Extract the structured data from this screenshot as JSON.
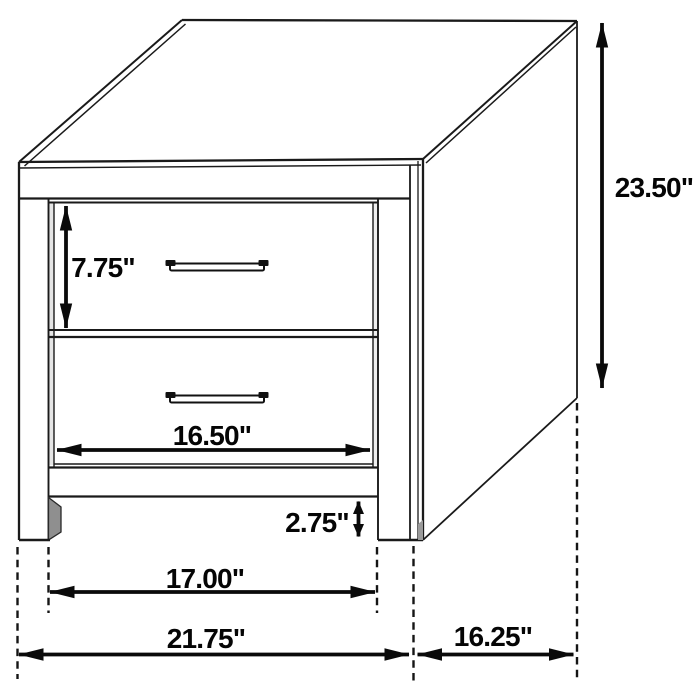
{
  "diagram": {
    "kind": "furniture-dimension-line-drawing",
    "dimensions": {
      "drawer_height": "7.75\"",
      "overall_height": "23.50\"",
      "drawer_width": "16.50\"",
      "base_clearance": "2.75\"",
      "leg_inner_span": "17.00\"",
      "overall_width": "21.75\"",
      "depth": "16.25\""
    },
    "colors": {
      "line": "#1a1a1a",
      "dimension": "#0a0a0a",
      "background": "#ffffff"
    }
  }
}
